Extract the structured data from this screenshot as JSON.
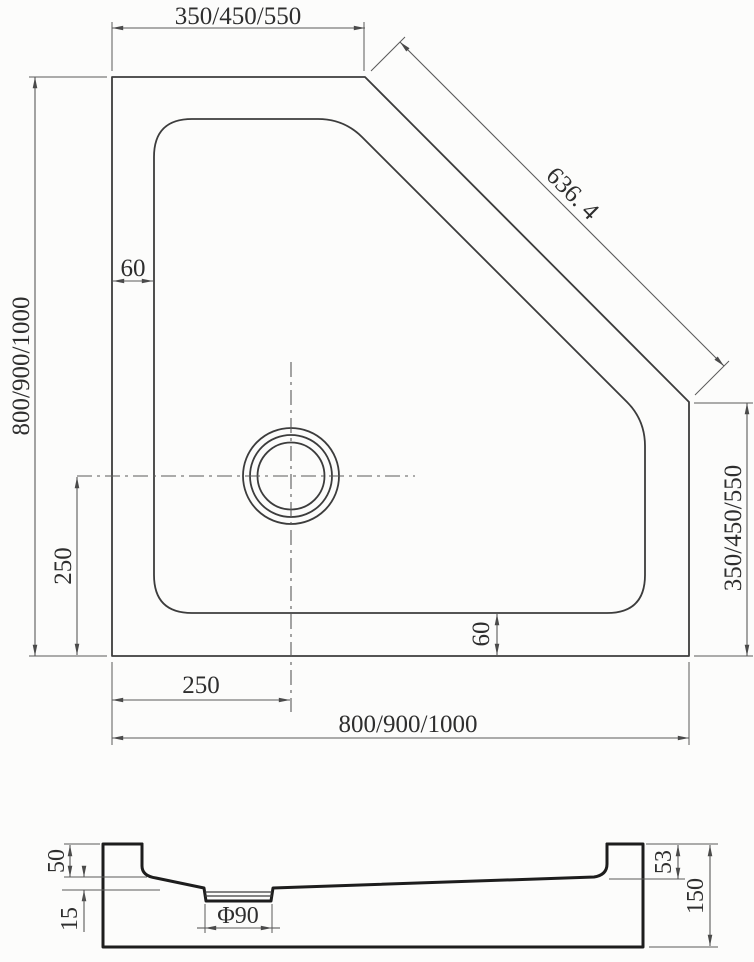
{
  "colors": {
    "background": "#fcfcfb",
    "line": "#3c3c3c",
    "section_line": "#1d1d1d",
    "dimension_line": "#5a5a5a",
    "text": "#2e2e2e"
  },
  "plan_view": {
    "dims": {
      "top_width": "350/450/550",
      "diagonal": "636. 4",
      "left_height": "800/900/1000",
      "rim_width_top": "60",
      "rim_width_bottom": "60",
      "drain_offset_left": "250",
      "drain_offset_bottom": "250",
      "right_height": "350/450/550",
      "bottom_width": "800/900/1000"
    }
  },
  "section_view": {
    "dims": {
      "rim_height_left": "50",
      "floor_drop": "15",
      "drain_diameter": "Φ90",
      "rim_height_right": "53",
      "total_height": "150"
    }
  }
}
